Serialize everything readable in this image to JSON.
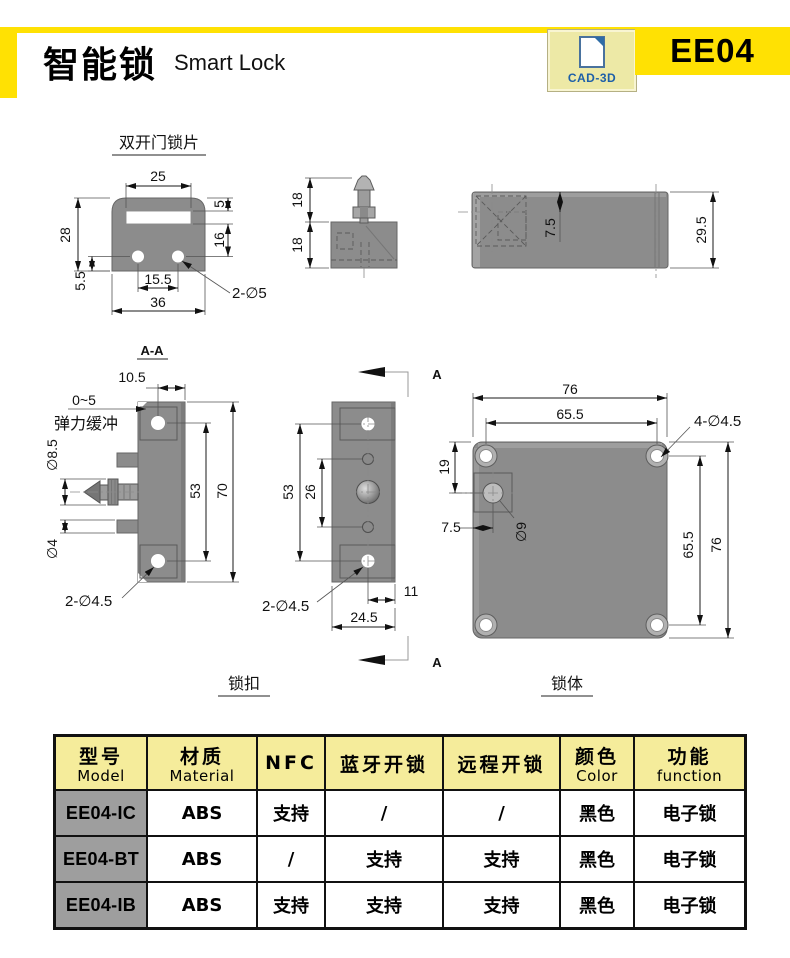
{
  "header": {
    "title_cn": "智能锁",
    "title_en": "Smart Lock",
    "badge_label": "CAD-3D",
    "product_code": "EE04"
  },
  "colors": {
    "accent_yellow": "#FFE103",
    "badge_bg": "#EDE9A6",
    "badge_text_blue": "#1D5FA8",
    "table_header_bg": "#F5EC9B",
    "model_column_bg": "#9E9E9E",
    "drawing_gray": "#8C8C8C"
  },
  "views": {
    "plate": {
      "title": "双开门锁片",
      "dim_slot_width": "25",
      "dim_slot_top_offset": "5",
      "dim_height": "28",
      "dim_slot_to_hole": "16",
      "dim_hole_to_bottom": "5.5",
      "dim_hole_spacing": "15.5",
      "dim_total_width": "36",
      "holes_note": "2-∅5"
    },
    "pin_side": {
      "dim_pin_height": "18",
      "dim_body_height": "18"
    },
    "body_side": {
      "dim_hole_offset": "7.5",
      "dim_thickness": "29.5"
    },
    "section": {
      "title": "A-A",
      "dim_top_width": "10.5",
      "buffer_range": "0~5",
      "buffer_label": "弹力缓冲",
      "pin_diameter": "∅8.5",
      "peg_diameter": "∅4",
      "dim_hole_spacing": "53",
      "dim_height": "70",
      "holes_note": "2-∅4.5"
    },
    "latch": {
      "label": "锁扣",
      "section_letter": "A",
      "dim_hole_spacing": "53",
      "dim_inner_spacing": "26",
      "dim_hole_to_edge": "11",
      "dim_width": "24.5",
      "holes_note": "2-∅4.5"
    },
    "body": {
      "label": "锁体",
      "dim_width": "76",
      "dim_hole_spacing_h": "65.5",
      "holes_note": "4-∅4.5",
      "dim_hole_top": "19",
      "dim_hole_left": "7.5",
      "center_hole_diameter": "∅9",
      "dim_hole_spacing_v": "65.5",
      "dim_height": "76"
    }
  },
  "table": {
    "headers": [
      {
        "cn": "型号",
        "en": "Model"
      },
      {
        "cn": "材质",
        "en": "Material"
      },
      {
        "cn": "NFC",
        "en": ""
      },
      {
        "cn": "蓝牙开锁",
        "en": ""
      },
      {
        "cn": "远程开锁",
        "en": ""
      },
      {
        "cn": "颜色",
        "en": "Color"
      },
      {
        "cn": "功能",
        "en": "function"
      }
    ],
    "rows": [
      [
        "EE04-IC",
        "ABS",
        "支持",
        "/",
        "/",
        "黑色",
        "电子锁"
      ],
      [
        "EE04-BT",
        "ABS",
        "/",
        "支持",
        "支持",
        "黑色",
        "电子锁"
      ],
      [
        "EE04-IB",
        "ABS",
        "支持",
        "支持",
        "支持",
        "黑色",
        "电子锁"
      ]
    ]
  }
}
